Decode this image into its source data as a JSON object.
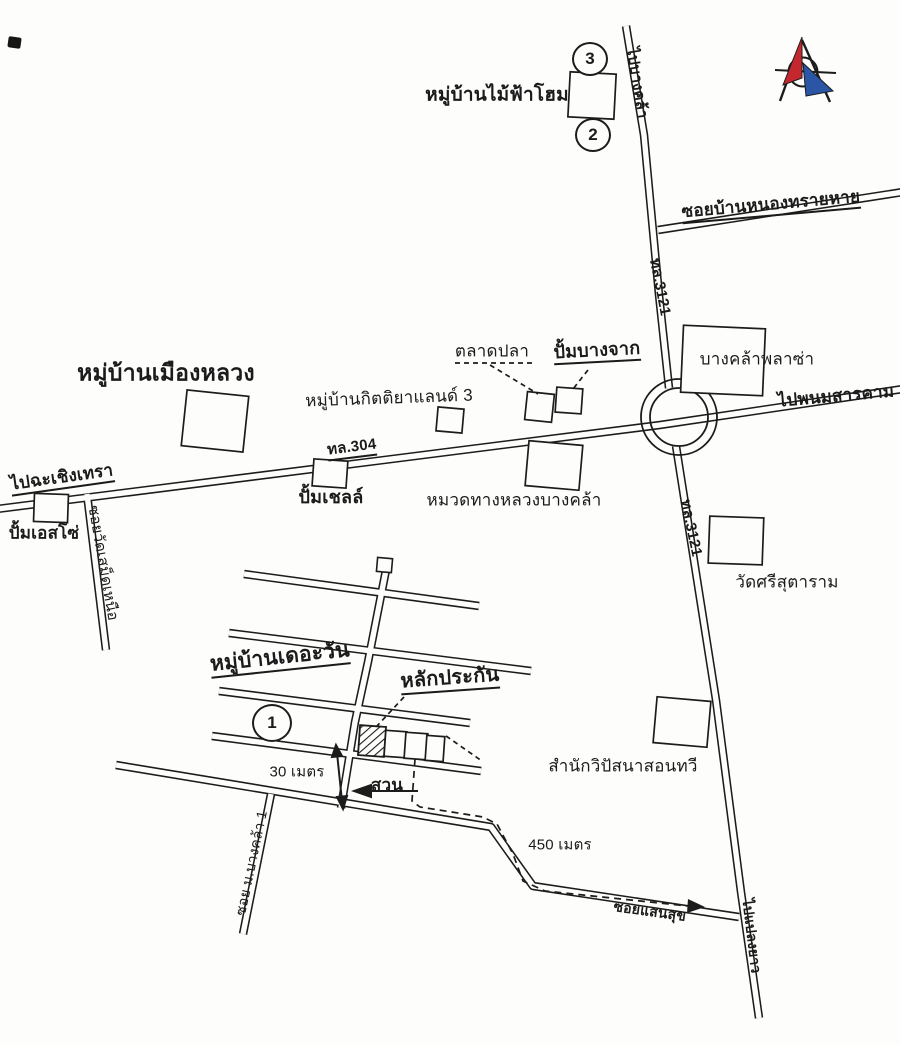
{
  "labels": {
    "village_maifahome": "หมู่บ้านไม้ฟ้าโฮม",
    "to_bangkhla": "ไปบางคล้า",
    "soi_ban_nong_sai_hai": "ซอยบ้านหนองทรายหาย",
    "hwy_3121_upper": "ทล.3121",
    "bangkhla_plaza": "บางคล้าพลาซ่า",
    "fish_market": "ตลาดปลา",
    "bangchak_station": "ปั้มบางจาก",
    "village_mueang_luang": "หมู่บ้านเมืองหลวง",
    "village_kittiya_land_3": "หมู่บ้านกิตติยาแลนด์ 3",
    "hwy_304": "ทล.304",
    "to_phanom_sarakham": "ไปพนมสารคาม",
    "to_chachoengsao": "ไปฉะเชิงเทรา",
    "esso_station": "ปั้มเอสโซ่",
    "soi_wat_samet_nuea": "ซอยวัดเสม็ดเหนือ",
    "shell_station": "ปั้มเชลล์",
    "highway_district_bangkhla": "หมวดทางหลวงบางคล้า",
    "wat_si_sutaram": "วัดศรีสุตาราม",
    "hwy_3121_lower": "ทล.3121",
    "village_the_one": "หมู่บ้านเดอะวัน",
    "collateral": "หลักประกัน",
    "meditation_center": "สำนักวิปัสนาสอนทวี",
    "garden": "สวน",
    "distance_30m": "30 เมตร",
    "distance_450m": "450 เมตร",
    "soi_m_bangkhla_1": "ซอย ม.บางคล้า 1",
    "soi_saen_suk": "ซอยแสนสุข",
    "to_plaeng_yao": "ไปแปลงยาว"
  },
  "markers": {
    "m1": "1",
    "m2": "2",
    "m3": "3"
  },
  "colors": {
    "ink": "#1c1c1c",
    "paper": "#fdfdfc",
    "compass_red": "#c4272e",
    "compass_blue": "#2b55a5"
  }
}
